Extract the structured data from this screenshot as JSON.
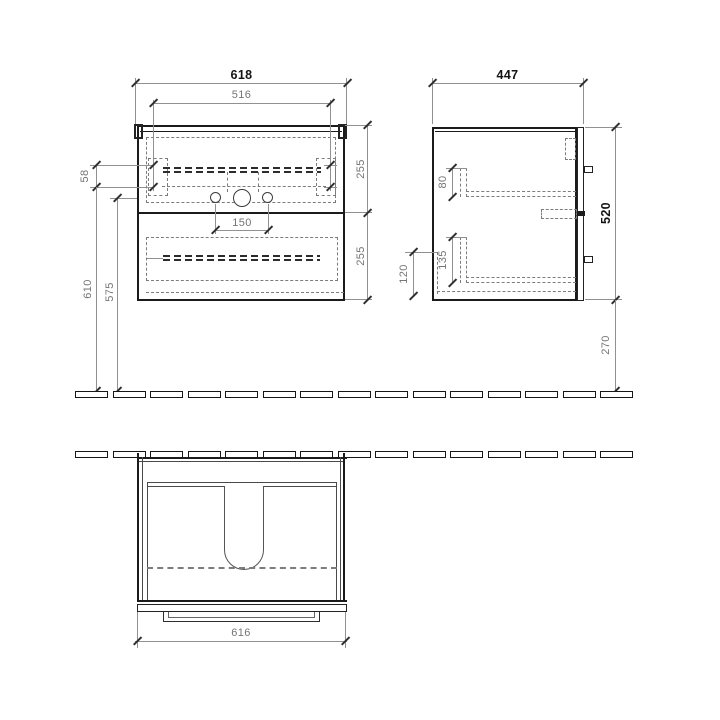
{
  "colors": {
    "outline": "#1b1b1b",
    "dimension_line": "#919191",
    "hidden_line": "#7c7c7c",
    "text_primary": "#141414",
    "text_secondary": "#757575",
    "background": "#ffffff"
  },
  "views": {
    "front": {
      "total_width": "618",
      "inner_width": "516",
      "fixing_offset": "58",
      "upper_section": "255",
      "lower_section": "255",
      "hole_spacing": "150",
      "height_to_fixing": "610",
      "height_to_drain": "575"
    },
    "side": {
      "depth": "447",
      "rail_upper": "80",
      "rail_lower": "135",
      "bottom_recess": "120",
      "cabinet_height": "520",
      "floor_clearance": "270"
    },
    "plan": {
      "front_width": "616"
    }
  }
}
